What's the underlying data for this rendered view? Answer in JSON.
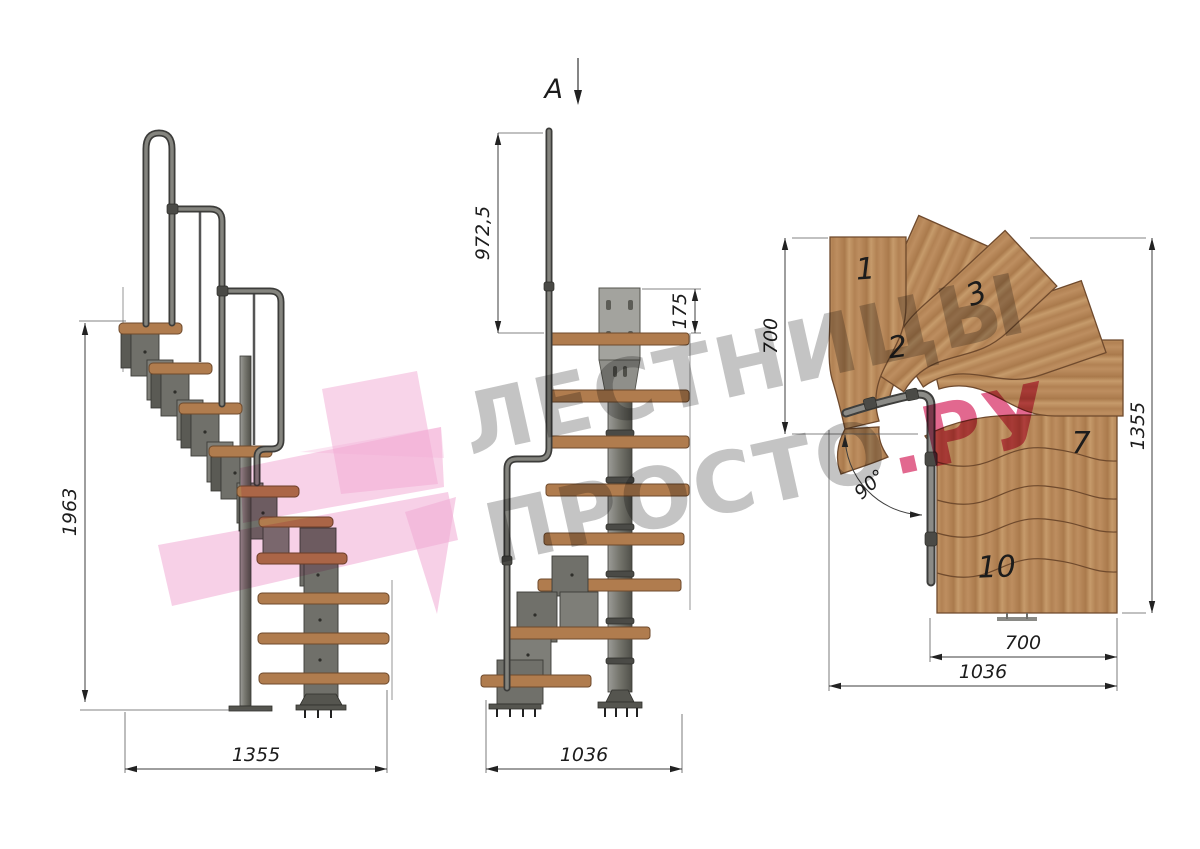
{
  "watermark": {
    "line1": "ЛЕСТНИЦЫ",
    "line2_gray": "ПРОСТО",
    "line2_pink": ".РУ"
  },
  "section_marker": {
    "label": "A"
  },
  "side_view": {
    "height_dim": "1963",
    "width_dim": "1355"
  },
  "front_view": {
    "rail_height_dim": "972,5",
    "bracket_height_dim": "175",
    "width_dim": "1036"
  },
  "plan_view": {
    "left_width_dim": "700",
    "depth_dim": "1355",
    "landing_width_dim": "700",
    "total_width_dim": "1036",
    "turn_angle_dim": "90°",
    "tread_numbers": {
      "t1": "1",
      "t2": "2",
      "t3": "3",
      "t7": "7",
      "t10": "10"
    }
  },
  "colors": {
    "watermark_gray": "#c4c4c4",
    "watermark_pink": "#e2688f",
    "logo_pink": "#f1a9d3",
    "wood": "#b4855b",
    "steel": "#6d6d68",
    "background": "#ffffff"
  }
}
